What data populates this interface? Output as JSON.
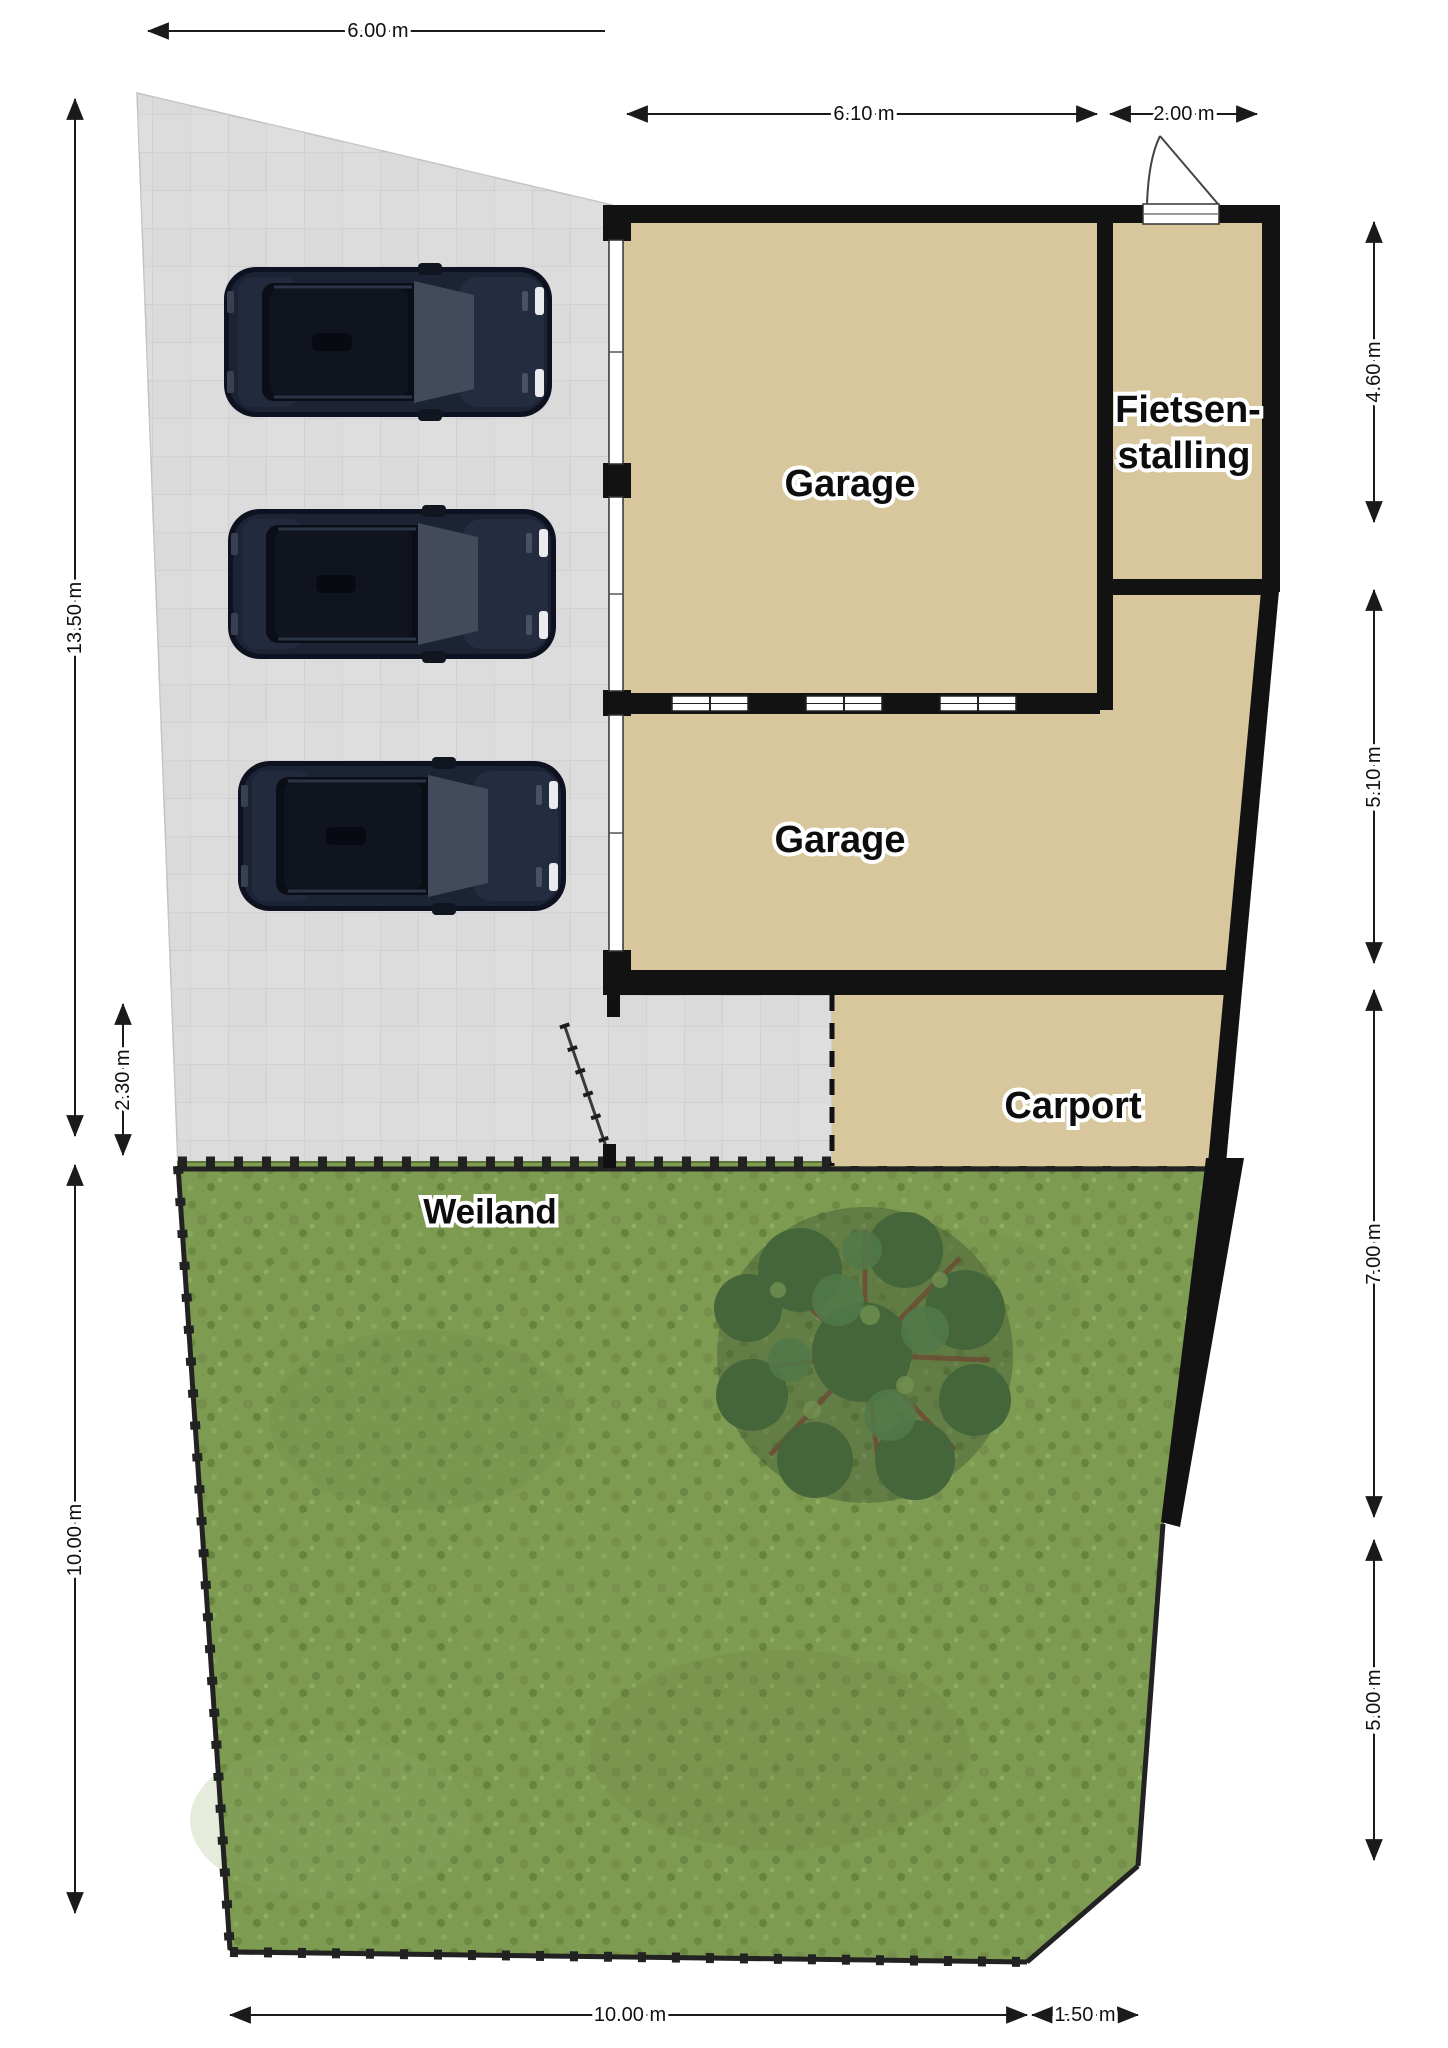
{
  "plan": {
    "type": "site-plan",
    "language": "nl"
  },
  "rooms": {
    "garage_top": "Garage",
    "fietsenstalling_line1": "Fietsen-",
    "fietsenstalling_line2": "stalling",
    "garage_middle": "Garage",
    "carport": "Carport",
    "weiland": "Weiland"
  },
  "dimensions": {
    "top_parking": "6.00 m",
    "top_garage": "6.10 m",
    "top_fietsenstalling": "2.00 m",
    "right_fietsenstalling": "4.60 m",
    "right_garage": "5.10 m",
    "right_carport": "7.00 m",
    "right_weiland": "5.00 m",
    "left_parking": "13.50 m",
    "left_strip": "2.30 m",
    "left_weiland": "10.00 m",
    "bottom_weiland": "10.00 m",
    "bottom_corner": "1.50 m"
  },
  "objects": {
    "cars": {
      "count": 3,
      "body_color": "#1c2334",
      "description": "three dark SUVs parked facing the garage doors"
    },
    "tree": {
      "foliage_color": "#44663a",
      "branch_color": "#6b4f35"
    }
  },
  "colors": {
    "wall": "#121212",
    "room_fill": "#d8c79c",
    "paving": "#dcdcdc",
    "paving_grid": "#cfcfcf",
    "grass": "#7e9b52",
    "background": "#ffffff"
  }
}
